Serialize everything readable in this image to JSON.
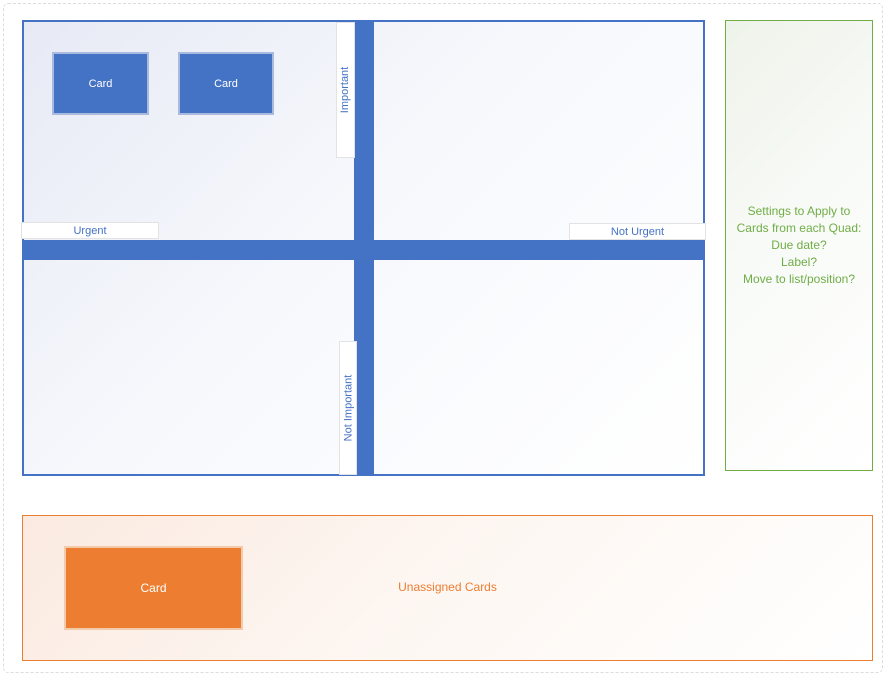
{
  "matrix": {
    "axis_labels": {
      "important": "Important",
      "not_important": "Not Important",
      "urgent": "Urgent",
      "not_urgent": "Not Urgent"
    },
    "cards": [
      {
        "label": "Card"
      },
      {
        "label": "Card"
      }
    ]
  },
  "settings_panel": {
    "lines": [
      "Settings to Apply to",
      "Cards from each Quad:",
      "Due date?",
      "Label?",
      "Move to list/position?"
    ]
  },
  "unassigned": {
    "title": "Unassigned Cards",
    "cards": [
      {
        "label": "Card"
      }
    ]
  },
  "colors": {
    "accent_blue": "#4472C4",
    "accent_green": "#70AD47",
    "accent_orange": "#ED7D31"
  }
}
